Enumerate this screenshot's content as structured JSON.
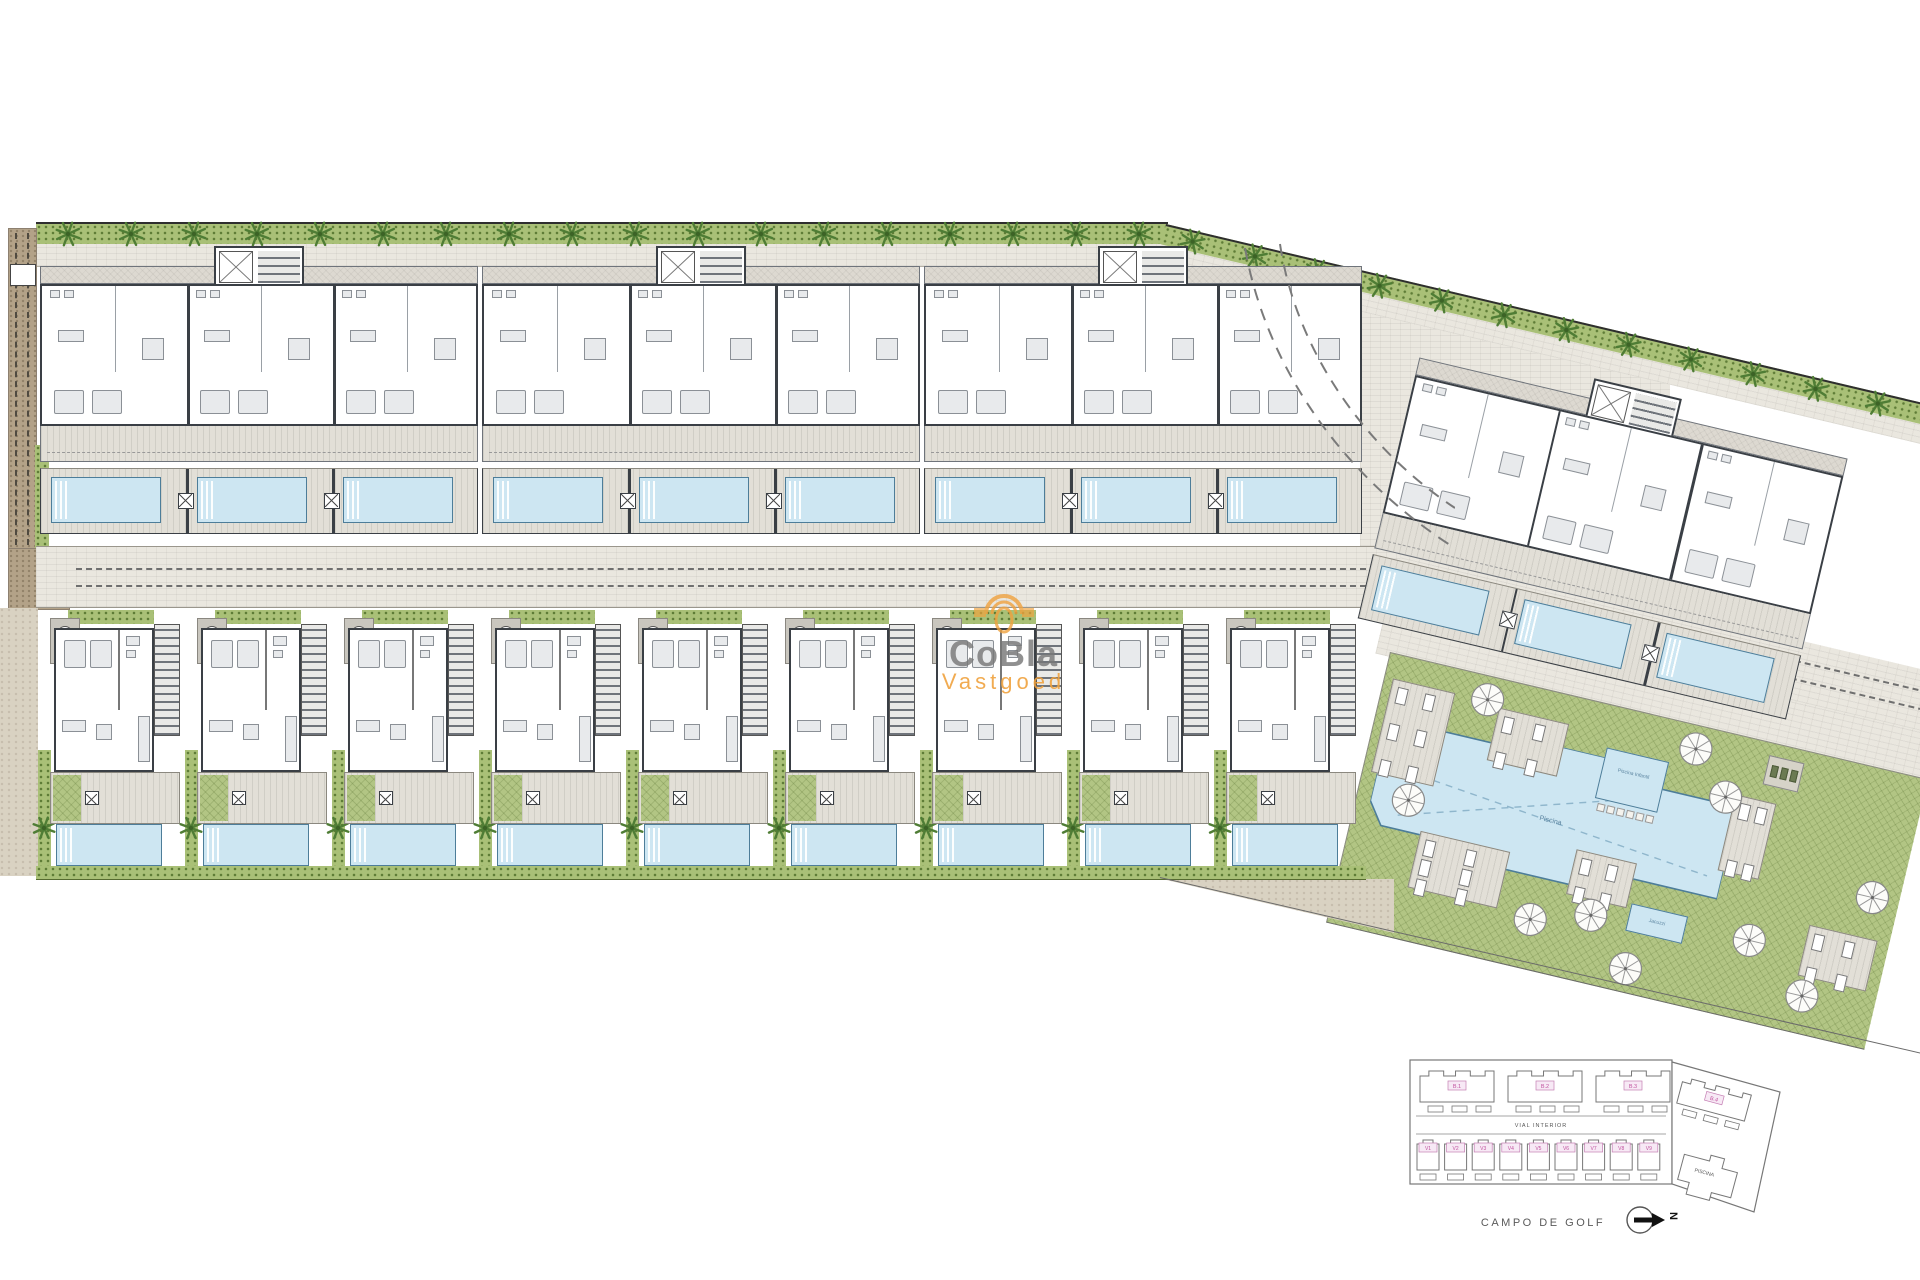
{
  "watermark": {
    "brand": "CoBla",
    "sub": "Vastgoed"
  },
  "keyplan": {
    "buildings": [
      {
        "label": "B.1"
      },
      {
        "label": "B.2"
      },
      {
        "label": "B.3"
      }
    ],
    "building4": {
      "label": "B.4"
    },
    "villas": [
      "V1",
      "V2",
      "V3",
      "V4",
      "V5",
      "V6",
      "V7",
      "V8",
      "V9"
    ],
    "road_label": "VIAL INTERIOR",
    "pool_label": "PISCINA",
    "bottom_label": "CAMPO DE GOLF",
    "north_label": "N"
  },
  "amenity": {
    "main_pool_label": "Piscina",
    "kids_pool_label": "Piscina Infantil",
    "spa_label": "Jacuzzi"
  },
  "colors": {
    "wall": "#3a3f45",
    "pool_fill": "#cde6f2",
    "pool_edge": "#4d7d99",
    "lawn": "#b2c584",
    "palm": "#4f7d35",
    "brand_gray": "#8f8f8f",
    "brand_orange": "#f0a23e",
    "keyplan_pink": "#c0519e",
    "keyplan_pink_fill": "#f7e9f5",
    "keyplan_line": "#777777"
  }
}
